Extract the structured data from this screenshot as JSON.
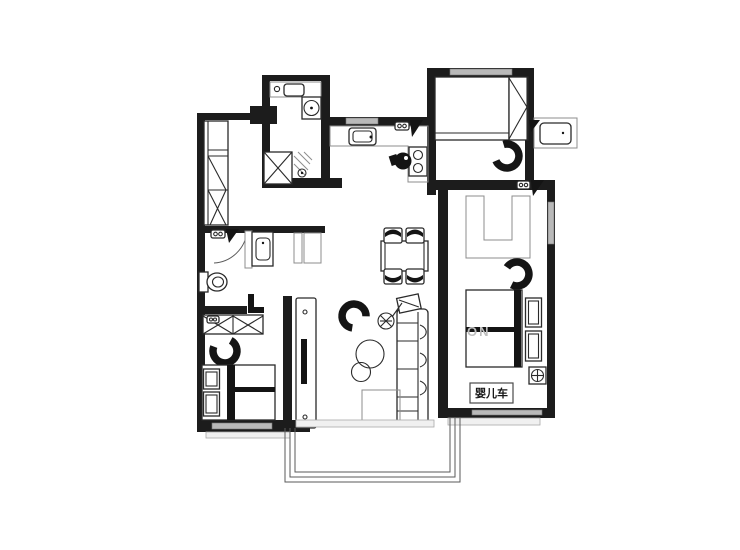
{
  "page": {
    "background": "#ffffff",
    "type": "apartment-floor-plan"
  },
  "plan": {
    "label_stroller": "婴儿车",
    "watermark": "ON",
    "colors": {
      "wall": "#1c1c1c",
      "furniture_line": "#2a2a2a",
      "light_line": "#8c8c8c",
      "window_fill": "#b9b9b9",
      "black_fill": "#141414",
      "background": "#ffffff"
    },
    "furniture_icons": [
      "entry-cabinet-icon",
      "laundry-counter-icon",
      "laundry-sink-icon",
      "washing-machine-icon",
      "shower-stall-icon",
      "floor-drain-icon",
      "toilet-icon",
      "vanity-sink-icon",
      "door-hinge-icon",
      "door-swing-arc-icon",
      "wardrobe-icon",
      "armchair-icon",
      "double-bed-icon",
      "pillow-icon",
      "tv-console-icon",
      "tv-icon",
      "sofa-icon",
      "side-table-icon",
      "floor-lamp-icon",
      "coffee-table-icon",
      "rug-icon",
      "dining-table-icon",
      "dining-chair-icon",
      "kitchen-counter-icon",
      "kitchen-sink-icon",
      "stove-icon",
      "pot-icon",
      "desk-closet-icon",
      "desk-chair-icon",
      "ac-unit-icon",
      "ceiling-lamp-icon",
      "stroller-area",
      "balcony-glazing",
      "window-strip"
    ]
  }
}
